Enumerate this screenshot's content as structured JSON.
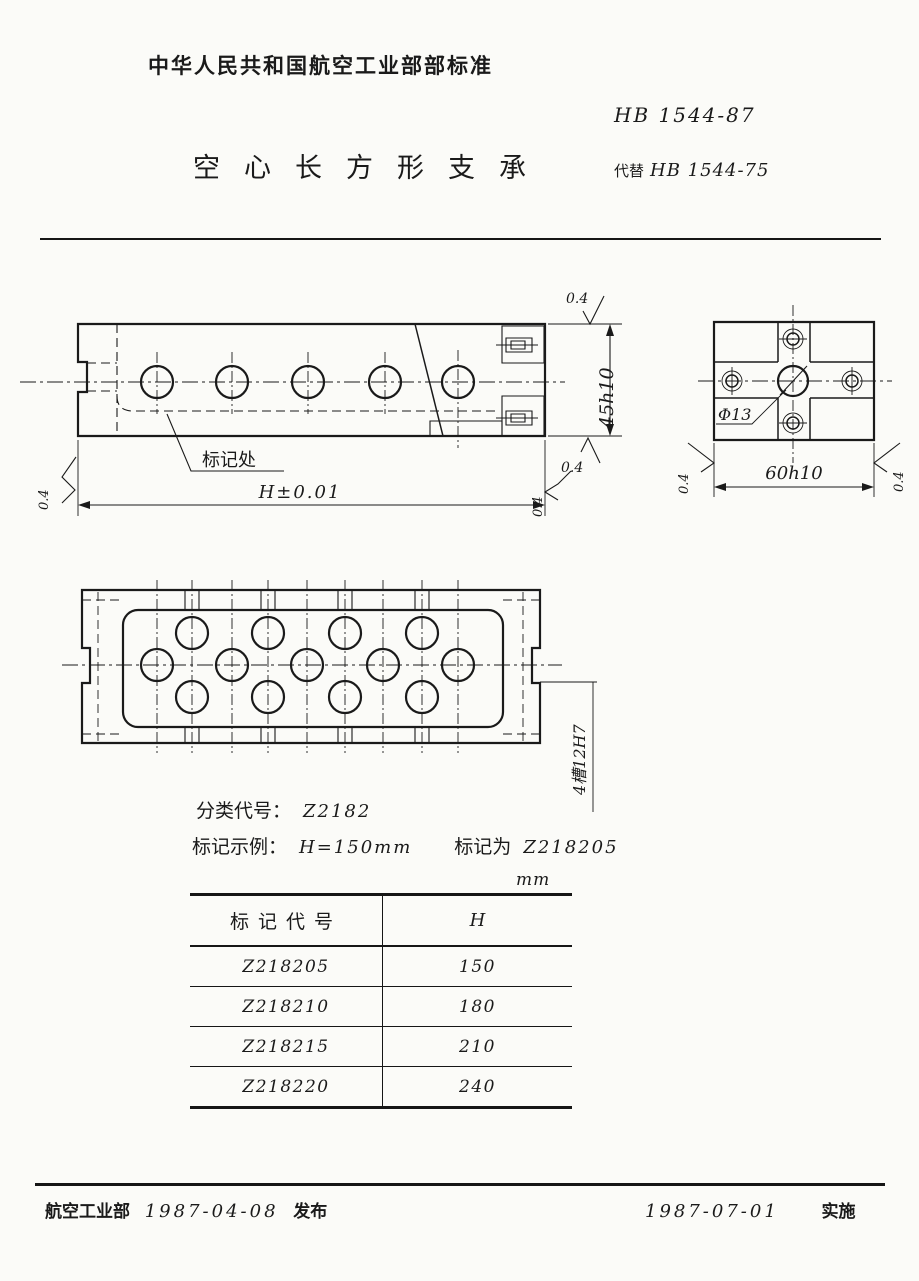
{
  "header": {
    "standard_name": "中华人民共和国航空工业部部标准",
    "doc_number": "HB 1544-87",
    "title": "空心长方形支承",
    "supersedes_label": "代替",
    "supersedes_number": "HB 1544-75"
  },
  "front_view": {
    "marking_label": "标记处",
    "width_dim": "H±0.01",
    "height_dim": "45h10"
  },
  "side_view": {
    "hole_dim": "Φ13",
    "width_dim": "60h10"
  },
  "plan_view": {
    "slots_label": "4槽12H7"
  },
  "finish": {
    "value": "0.4"
  },
  "notes": {
    "class_label": "分类代号：",
    "class_code": "Z2182",
    "example_label": "标记示例：",
    "example_condition": "H=150mm",
    "example_result_label": "标记为",
    "example_result_code": "Z218205"
  },
  "table": {
    "unit": "mm",
    "col1": "标记代号",
    "col2": "H",
    "rows": [
      {
        "code": "Z218205",
        "h": "150"
      },
      {
        "code": "Z218210",
        "h": "180"
      },
      {
        "code": "Z218215",
        "h": "210"
      },
      {
        "code": "Z218220",
        "h": "240"
      }
    ]
  },
  "footer": {
    "org": "航空工业部",
    "issue_date": "1987-04-08",
    "issue_label": "发布",
    "impl_date": "1987-07-01",
    "impl_label": "实施"
  }
}
